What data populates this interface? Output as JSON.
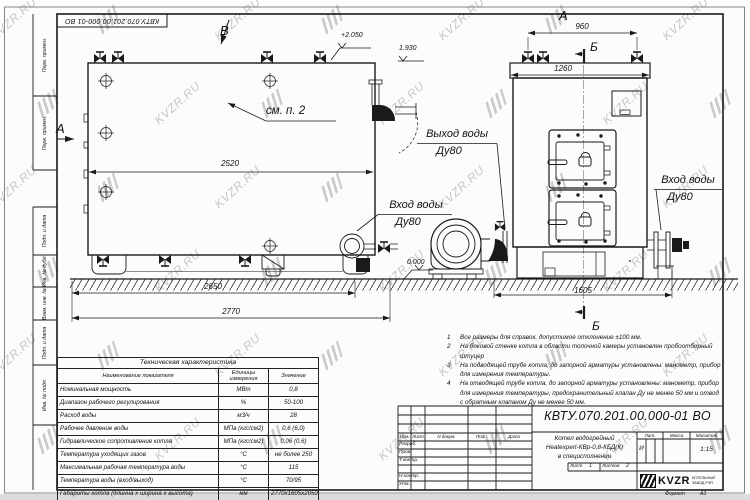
{
  "watermark": {
    "text": "KVZR.RU"
  },
  "corner_stamp": {
    "text": "КВТУ.070.201.00.000-01 ВО"
  },
  "margin_labels": [
    "Перв. примен.",
    "Перв. примен.",
    "Подп. и дата",
    "Инв. № дубл.",
    "Взам. инв. №",
    "Подп. и дата",
    "Инв. № подл."
  ],
  "drawing": {
    "view_letters": {
      "a_side": "А",
      "b_top": "В",
      "a_front": "А",
      "b_front_top": "Б",
      "b_front_bottom": "Б"
    },
    "dimensions": {
      "side_width": "2520",
      "side_base": "2650",
      "side_overall": "2770",
      "front_valves": "960",
      "front_top": "1260",
      "front_base": "1605"
    },
    "elevations": {
      "top": "+2.050",
      "mid": "1.930",
      "zero": "0.000"
    },
    "callouts": {
      "see_note": "см. п. 2",
      "side_inlet": "Вход воды",
      "side_inlet_dn": "Ду80",
      "front_outlet": "Выход воды",
      "front_outlet_dn": "Ду80",
      "front_inlet": "Вход воды",
      "front_inlet_dn": "Ду80"
    }
  },
  "tech_table": {
    "title": "Техническая характеристика",
    "headers": [
      "Наименование показателя",
      "Единицы измерения",
      "Значение"
    ],
    "rows": [
      [
        "Номинальная мощность",
        "МВт",
        "0,8"
      ],
      [
        "Диапазон рабочего регулирования",
        "%",
        "50-100"
      ],
      [
        "Расход воды",
        "м3/ч",
        "28"
      ],
      [
        "Рабочее давление воды",
        "МПа (кгс/см2)",
        "0,6 (6,0)"
      ],
      [
        "Гидравлическое сопротивление котла",
        "МПа (кгс/см2)",
        "0,06 (0,6)"
      ],
      [
        "Температура уходящих газов",
        "°С",
        "не более 250"
      ],
      [
        "Максимальная рабочая температура воды",
        "°С",
        "115"
      ],
      [
        "Температура воды (вход/выход)",
        "°С",
        "70/95"
      ],
      [
        "Габариты котла (длинна х ширина х высота)",
        "мм",
        "2770х1605х2050"
      ]
    ]
  },
  "notes": {
    "items": [
      {
        "num": "1",
        "text": "Все размеры для справок, допустимое отклонение ±100 мм."
      },
      {
        "num": "2",
        "text": "На боковой стенке котла в области топочной камеры установлен пробоотборный штуцер"
      },
      {
        "num": "3",
        "text": "На подводящей трубе котла, до запорной арматуры установлены: манометр, прибор для измерения температуры."
      },
      {
        "num": "4",
        "text": "На отводящей трубе котла, до запорной арматуры установлены: манометр, прибор для измерения температуры, предохранительный клапан Ду не менее 50 мм и отвод с обратным клапаном Ду не менее 50 мм."
      }
    ]
  },
  "title_block": {
    "doc_number": "КВТУ.070.201.00.000-01 ВО",
    "product_name_line1": "Котел водогрейный",
    "product_name_line2": "Heatexpert-КВр-0,8-КБД(К)",
    "product_name_line3": "в специсполнении",
    "header_cols": [
      "Изм.",
      "Лист",
      "N докум.",
      "Подп.",
      "Дата"
    ],
    "sig_rows": [
      "Разраб.",
      "Пров.",
      "Т.контр.",
      "Н.контр.",
      "Утв."
    ],
    "lit_label": "Лит.",
    "lit_value": "И",
    "mass_label": "Масса",
    "scale_label": "Масштаб",
    "scale_value": "1:15",
    "sheet_label": "Лист",
    "sheet_value": "1",
    "sheets_label": "Листов",
    "sheets_value": "2",
    "logo_text": "KVZR",
    "company_line1": "КОТЕЛЬНЫЙ",
    "company_line2": "ЗАВОД РЭП",
    "format_label": "Формат",
    "format_value": "А3"
  }
}
